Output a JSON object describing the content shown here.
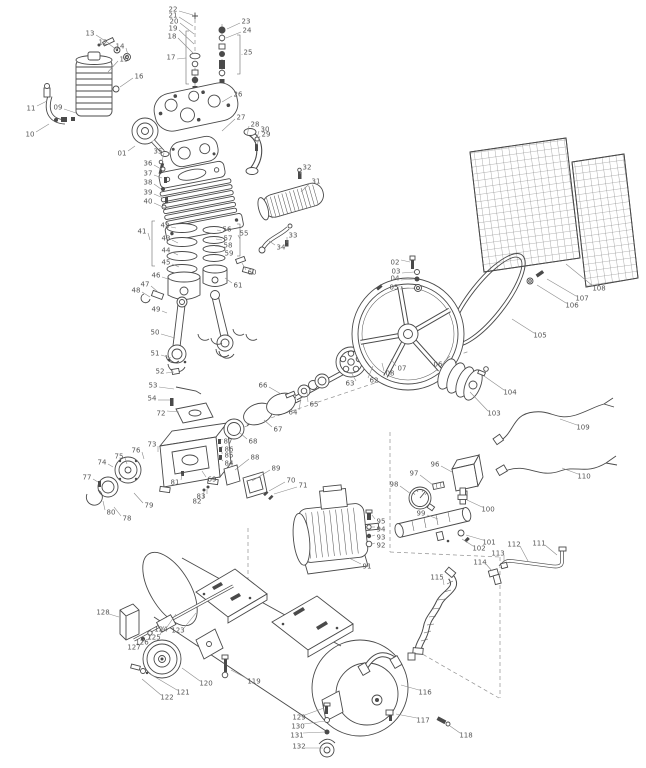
{
  "figure": {
    "type": "exploded-parts-diagram",
    "subject": "belt-driven air compressor parts explosion",
    "background": "#ffffff",
    "line_color": "#4a4a4a",
    "label_color": "#555555",
    "leader_color": "#8c8c8c",
    "label_count": 131
  },
  "labels": [
    [
      "13",
      90,
      33,
      110,
      44
    ],
    [
      "12",
      103,
      42,
      117,
      50
    ],
    [
      "14",
      120,
      46,
      128,
      55
    ],
    [
      "15",
      124,
      59,
      108,
      72
    ],
    [
      "16",
      139,
      76,
      120,
      87
    ],
    [
      "11",
      31,
      108,
      47,
      101
    ],
    [
      "09",
      58,
      107,
      76,
      113
    ],
    [
      "10",
      30,
      134,
      49,
      124
    ],
    [
      "01",
      122,
      153,
      135,
      146
    ],
    [
      "35",
      158,
      151,
      162,
      161
    ],
    [
      "22",
      173,
      9,
      193,
      15
    ],
    [
      "21",
      173,
      15,
      193,
      26
    ],
    [
      "20",
      174,
      21,
      194,
      34
    ],
    [
      "19",
      173,
      28,
      194,
      44
    ],
    [
      "18",
      172,
      36,
      194,
      54
    ],
    [
      "17",
      171,
      57,
      186,
      58
    ],
    [
      "23",
      246,
      21,
      227,
      29
    ],
    [
      "24",
      247,
      30,
      226,
      38
    ],
    [
      "25",
      248,
      52,
      242,
      55
    ],
    [
      "26",
      238,
      94,
      222,
      102
    ],
    [
      "27",
      241,
      117,
      222,
      131
    ],
    [
      "28",
      255,
      124,
      247,
      136
    ],
    [
      "30",
      265,
      129,
      257,
      138
    ],
    [
      "29",
      266,
      134,
      257,
      145
    ],
    [
      "32",
      307,
      167,
      300,
      174
    ],
    [
      "31",
      316,
      181,
      301,
      192
    ],
    [
      "36",
      148,
      163,
      161,
      169
    ],
    [
      "37",
      148,
      173,
      162,
      178
    ],
    [
      "38",
      148,
      182,
      161,
      189
    ],
    [
      "39",
      148,
      192,
      163,
      198
    ],
    [
      "40",
      148,
      201,
      165,
      208
    ],
    [
      "33",
      293,
      235,
      287,
      243
    ],
    [
      "34",
      281,
      247,
      269,
      241
    ],
    [
      "41",
      142,
      231,
      150,
      240
    ],
    [
      "42",
      165,
      225,
      176,
      228
    ],
    [
      "43",
      166,
      238,
      178,
      243
    ],
    [
      "44",
      166,
      250,
      178,
      255
    ],
    [
      "45",
      166,
      262,
      179,
      267
    ],
    [
      "46",
      156,
      275,
      171,
      280
    ],
    [
      "47",
      145,
      284,
      158,
      292
    ],
    [
      "48",
      136,
      290,
      150,
      297
    ],
    [
      "49",
      156,
      309,
      167,
      313
    ],
    [
      "55",
      244,
      233,
      240,
      239
    ],
    [
      "56",
      227,
      229,
      217,
      230
    ],
    [
      "57",
      228,
      238,
      216,
      239
    ],
    [
      "58",
      228,
      245,
      215,
      246
    ],
    [
      "59",
      229,
      253,
      215,
      253
    ],
    [
      "60",
      252,
      272,
      242,
      263
    ],
    [
      "61",
      238,
      285,
      225,
      278
    ],
    [
      "50",
      155,
      332,
      175,
      338
    ],
    [
      "51",
      155,
      353,
      171,
      358
    ],
    [
      "52",
      160,
      371,
      174,
      372
    ],
    [
      "53",
      153,
      385,
      174,
      389
    ],
    [
      "54",
      152,
      398,
      170,
      400
    ],
    [
      "72",
      161,
      413,
      179,
      412
    ],
    [
      "66",
      263,
      385,
      281,
      394
    ],
    [
      "64",
      293,
      412,
      301,
      398
    ],
    [
      "65",
      314,
      404,
      307,
      392
    ],
    [
      "63",
      350,
      383,
      351,
      372
    ],
    [
      "62",
      374,
      380,
      373,
      366
    ],
    [
      "08",
      390,
      373,
      382,
      363
    ],
    [
      "07",
      402,
      368,
      391,
      359
    ],
    [
      "06",
      438,
      364,
      450,
      356
    ],
    [
      "67",
      278,
      429,
      264,
      420
    ],
    [
      "68",
      253,
      441,
      240,
      433
    ],
    [
      "69",
      212,
      479,
      202,
      471
    ],
    [
      "87",
      228,
      441,
      222,
      440
    ],
    [
      "86",
      229,
      449,
      221,
      447
    ],
    [
      "85",
      229,
      455,
      221,
      453
    ],
    [
      "84",
      229,
      463,
      221,
      459
    ],
    [
      "88",
      255,
      457,
      235,
      470
    ],
    [
      "89",
      276,
      468,
      252,
      481
    ],
    [
      "70",
      291,
      480,
      269,
      491
    ],
    [
      "71",
      303,
      485,
      274,
      494
    ],
    [
      "81",
      175,
      482,
      182,
      474
    ],
    [
      "83",
      201,
      496,
      207,
      489
    ],
    [
      "82",
      197,
      501,
      204,
      492
    ],
    [
      "73",
      152,
      444,
      158,
      452
    ],
    [
      "76",
      136,
      450,
      144,
      459
    ],
    [
      "75",
      119,
      456,
      127,
      464
    ],
    [
      "74",
      102,
      462,
      113,
      467
    ],
    [
      "77",
      87,
      477,
      98,
      482
    ],
    [
      "79",
      149,
      505,
      134,
      493
    ],
    [
      "80",
      111,
      512,
      103,
      501
    ],
    [
      "78",
      127,
      518,
      114,
      507
    ],
    [
      "02",
      395,
      262,
      410,
      262
    ],
    [
      "03",
      396,
      271,
      414,
      272
    ],
    [
      "04",
      395,
      278,
      414,
      279
    ],
    [
      "05",
      394,
      287,
      414,
      288
    ],
    [
      "103",
      494,
      413,
      470,
      392
    ],
    [
      "104",
      510,
      392,
      484,
      376
    ],
    [
      "105",
      540,
      335,
      512,
      319
    ],
    [
      "106",
      572,
      305,
      537,
      285
    ],
    [
      "107",
      582,
      298,
      547,
      279
    ],
    [
      "108",
      599,
      288,
      566,
      264
    ],
    [
      "109",
      583,
      427,
      560,
      419
    ],
    [
      "110",
      584,
      476,
      562,
      468
    ],
    [
      "95",
      381,
      521,
      372,
      515
    ],
    [
      "94",
      381,
      529,
      372,
      527
    ],
    [
      "93",
      381,
      537,
      372,
      536
    ],
    [
      "92",
      381,
      545,
      372,
      544
    ],
    [
      "91",
      367,
      566,
      349,
      558
    ],
    [
      "96",
      435,
      464,
      452,
      472
    ],
    [
      "97",
      414,
      473,
      433,
      485
    ],
    [
      "98",
      394,
      484,
      411,
      494
    ],
    [
      "99",
      421,
      513,
      438,
      519
    ],
    [
      "100",
      488,
      509,
      467,
      500
    ],
    [
      "101",
      489,
      542,
      466,
      535
    ],
    [
      "102",
      479,
      548,
      462,
      539
    ],
    [
      "111",
      539,
      543,
      557,
      555
    ],
    [
      "112",
      514,
      544,
      528,
      561
    ],
    [
      "113",
      498,
      553,
      504,
      563
    ],
    [
      "114",
      480,
      562,
      492,
      571
    ],
    [
      "115",
      437,
      577,
      444,
      585
    ],
    [
      "116",
      425,
      692,
      401,
      685
    ],
    [
      "117",
      423,
      720,
      396,
      714
    ],
    [
      "118",
      466,
      735,
      450,
      726
    ],
    [
      "119",
      254,
      681,
      231,
      670
    ],
    [
      "120",
      206,
      683,
      182,
      668
    ],
    [
      "121",
      183,
      692,
      150,
      674
    ],
    [
      "122",
      167,
      697,
      142,
      679
    ],
    [
      "123",
      178,
      630,
      196,
      613
    ],
    [
      "124",
      161,
      629,
      176,
      614
    ],
    [
      "125",
      154,
      637,
      164,
      626
    ],
    [
      "126",
      142,
      642,
      152,
      633
    ],
    [
      "127",
      134,
      647,
      144,
      639
    ],
    [
      "128",
      103,
      612,
      119,
      617
    ],
    [
      "129",
      299,
      717,
      324,
      708
    ],
    [
      "130",
      298,
      726,
      325,
      721
    ],
    [
      "131",
      297,
      735,
      325,
      732
    ],
    [
      "132",
      299,
      746,
      323,
      748
    ]
  ]
}
